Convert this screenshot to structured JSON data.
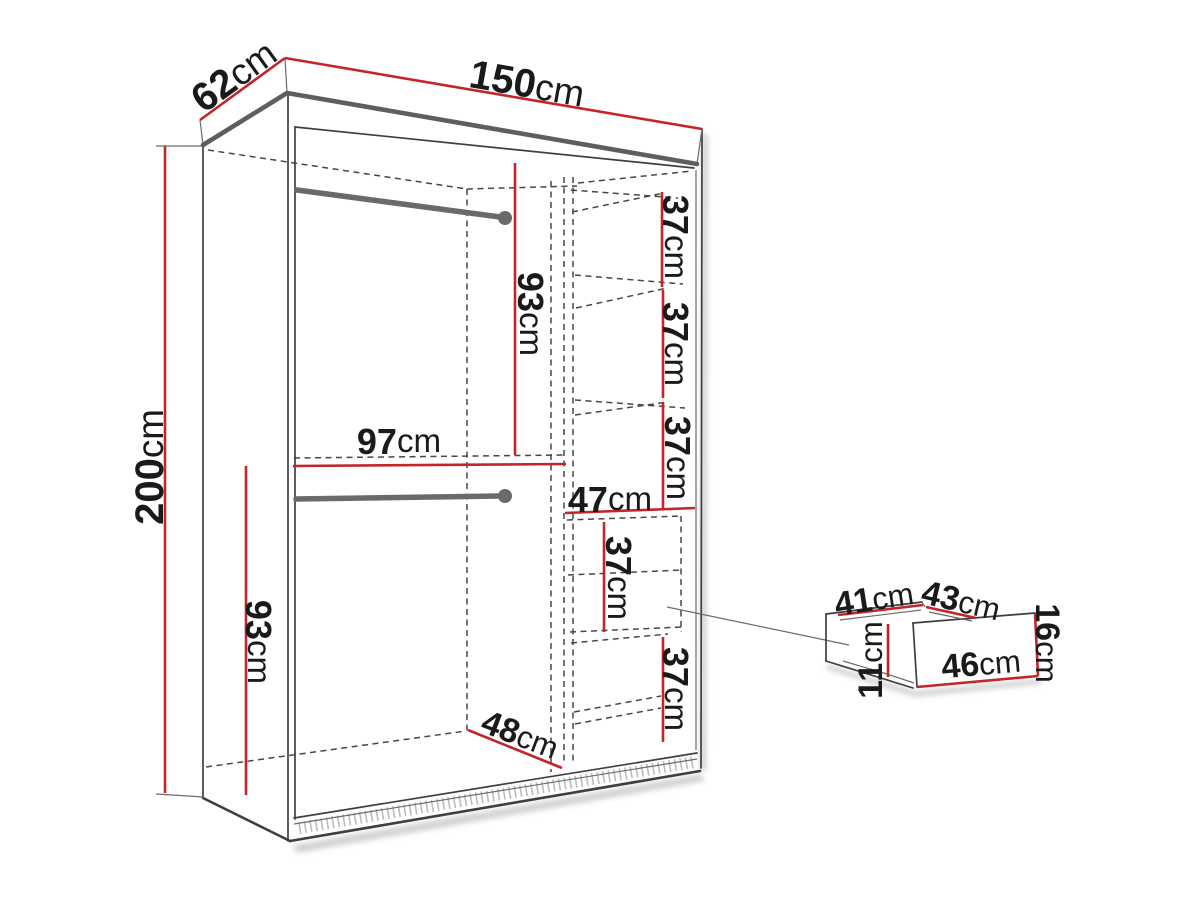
{
  "title": "Wardrobe dimension diagram",
  "colors": {
    "dimension_red": "#c2262b",
    "outline_dark": "#3f3f3f",
    "panel_gray": "#5e5e5e",
    "text": "#1a1a1a",
    "background": "#ffffff"
  },
  "wardrobe": {
    "width": {
      "value": "150",
      "unit": "cm"
    },
    "depth": {
      "value": "62",
      "unit": "cm"
    },
    "height": {
      "value": "200",
      "unit": "cm"
    },
    "upper_hanging_height": {
      "value": "93",
      "unit": "cm"
    },
    "lower_hanging_height": {
      "value": "93",
      "unit": "cm"
    },
    "hanging_section_width": {
      "value": "97",
      "unit": "cm"
    },
    "interior_depth": {
      "value": "48",
      "unit": "cm"
    },
    "shelf_section_width": {
      "value": "47",
      "unit": "cm"
    },
    "shelf_gaps": [
      {
        "value": "37",
        "unit": "cm"
      },
      {
        "value": "37",
        "unit": "cm"
      },
      {
        "value": "37",
        "unit": "cm"
      },
      {
        "value": "37",
        "unit": "cm"
      },
      {
        "value": "37",
        "unit": "cm"
      }
    ]
  },
  "drawer": {
    "inner_depth": {
      "value": "41",
      "unit": "cm"
    },
    "inner_width": {
      "value": "43",
      "unit": "cm"
    },
    "front_height": {
      "value": "16",
      "unit": "cm"
    },
    "front_width": {
      "value": "46",
      "unit": "cm"
    },
    "inner_height": {
      "value": "11",
      "unit": "cm"
    }
  }
}
